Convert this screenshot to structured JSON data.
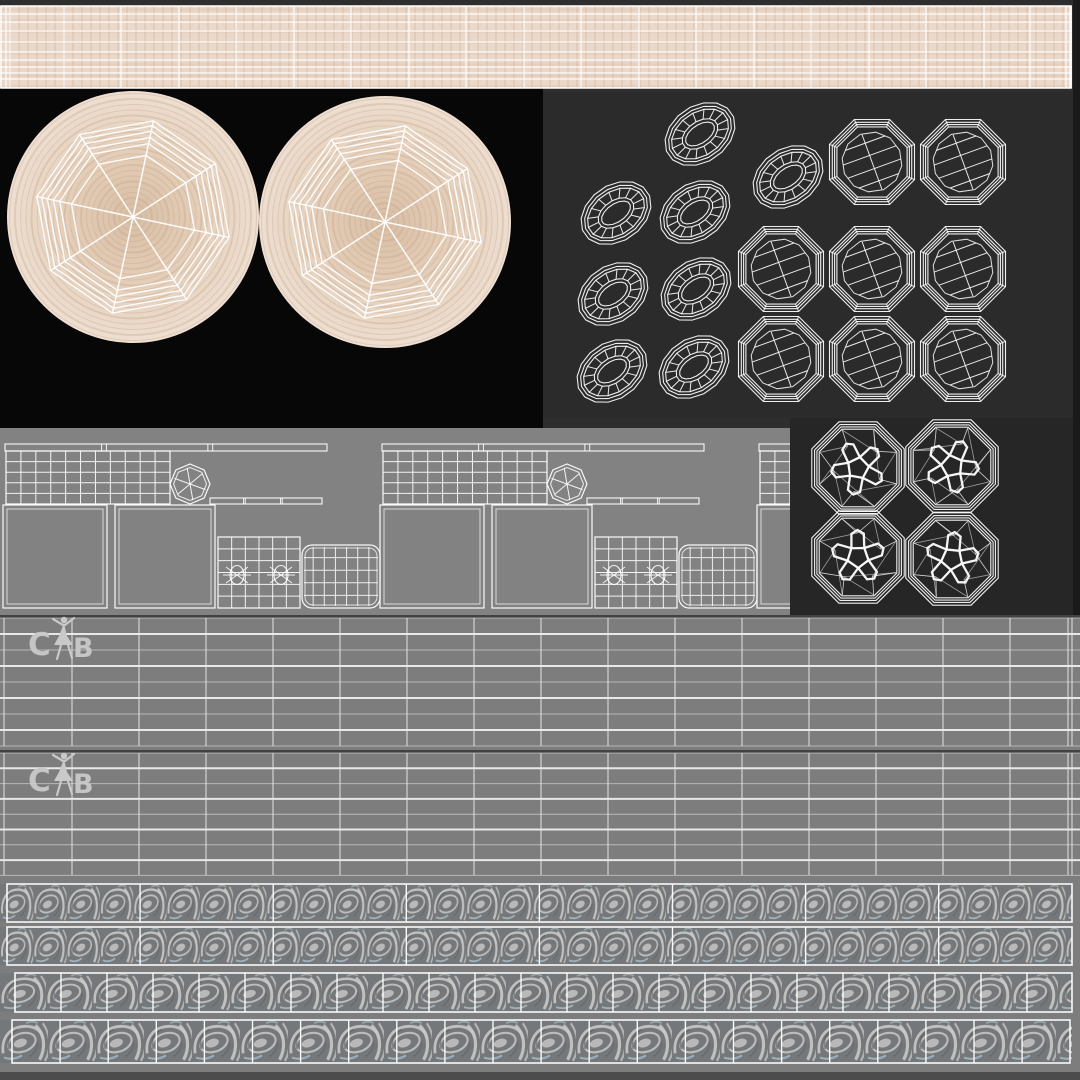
{
  "title": "3D model UV wireframe texture atlas",
  "logo": {
    "name": "CB ballet brand mark",
    "letter_left": "C",
    "letter_right": "B"
  },
  "colors": {
    "canvas_bg": "#2e2e2e",
    "wood": "#ead8ca",
    "wood_center": "#d8bda4",
    "wood_mid": "#e2cbb5",
    "wood_edge": "#eedfd2",
    "wood_grain": "#c2a184",
    "black_panel": "#070707",
    "rings_panel": "#2b2b2b",
    "gems_panel": "#262626",
    "gray_panel": "#828282",
    "band_bg": "#7d7d7d",
    "wire": "#ffffff",
    "band_line": "#e9e9e9",
    "band_line_bright": "#f4f4f4",
    "section_border": "#3c3c3c",
    "logo_color": "#c9c9c9",
    "wave_bg": "#75787b",
    "wave_light": "#c9c9c7",
    "wave_blue": "#b3c8d4",
    "wave_dark": "#5a5e62",
    "right_band": "#1a1a1a",
    "bottom_strip": "#4c4c4c",
    "lower_bg": "#7d7d7d"
  },
  "wood_strip": {
    "x": 0,
    "y": 6,
    "w": 1072,
    "h": 82,
    "verticals": [
      6,
      10,
      64,
      121,
      179,
      236,
      294,
      351,
      409,
      466,
      524,
      581,
      639,
      696,
      754,
      811,
      869,
      926,
      984,
      1030,
      1066,
      1070
    ],
    "horizontals": [
      8,
      16,
      25,
      36,
      46,
      54,
      61,
      67,
      73
    ]
  },
  "disc_panel": {
    "x": 0,
    "y": 88,
    "w": 543,
    "h": 340,
    "discs": [
      {
        "cx": 133,
        "cy": 217,
        "r": 126
      },
      {
        "cx": 385,
        "cy": 222,
        "r": 126
      }
    ],
    "ring_fracs": [
      0.5,
      0.595,
      0.645,
      0.695,
      0.74,
      0.78
    ],
    "spoke_angle_offset": 12
  },
  "rings_panel": {
    "x": 543,
    "y": 92,
    "w": 530,
    "h": 326,
    "oval_rot": -35,
    "oval_rx": 38,
    "oval_ry": 28,
    "ovals": [
      {
        "cx": 700,
        "cy": 134
      },
      {
        "cx": 788,
        "cy": 177
      },
      {
        "cx": 616,
        "cy": 213
      },
      {
        "cx": 695,
        "cy": 212
      },
      {
        "cx": 613,
        "cy": 294
      },
      {
        "cx": 696,
        "cy": 289
      },
      {
        "cx": 612,
        "cy": 371
      },
      {
        "cx": 694,
        "cy": 367
      }
    ],
    "disc_r": 46,
    "discs": [
      {
        "cx": 872,
        "cy": 162
      },
      {
        "cx": 963,
        "cy": 162
      },
      {
        "cx": 781,
        "cy": 269
      },
      {
        "cx": 872,
        "cy": 269
      },
      {
        "cx": 963,
        "cy": 269
      },
      {
        "cx": 781,
        "cy": 359
      },
      {
        "cx": 872,
        "cy": 359
      },
      {
        "cx": 963,
        "cy": 359
      }
    ]
  },
  "gray_panel": {
    "x": 0,
    "y": 428,
    "w": 790,
    "h": 187,
    "copy_offsets": [
      0,
      377,
      754
    ]
  },
  "gems_panel": {
    "x": 790,
    "y": 418,
    "w": 283,
    "h": 197,
    "r": 50,
    "gems": [
      {
        "cx": 858,
        "cy": 468,
        "rot": 10
      },
      {
        "cx": 952,
        "cy": 466,
        "rot": -12
      },
      {
        "cx": 858,
        "cy": 557,
        "rot": 35
      },
      {
        "cx": 952,
        "cy": 559,
        "rot": -30
      }
    ]
  },
  "band_sections": [
    {
      "y": 615,
      "h": 133,
      "rows": 9,
      "row_step": 16.0,
      "logo_x": 28,
      "logo_y": 616
    },
    {
      "y": 750,
      "h": 127,
      "rows": 9,
      "row_step": 15.3,
      "logo_x": 28,
      "logo_y": 752
    }
  ],
  "band_verticals": [
    4,
    72,
    139,
    206,
    273,
    340,
    407,
    474,
    541,
    608,
    675,
    742,
    809,
    876,
    943,
    1010,
    1068,
    1072
  ],
  "wave_rows": [
    {
      "y": 884,
      "h": 38,
      "x0": 7,
      "x1": 1072,
      "step": 133.1,
      "motif_w": 33.3
    },
    {
      "y": 927,
      "h": 38,
      "x0": 7,
      "x1": 1072,
      "step": 133.1,
      "motif_w": 33.3
    },
    {
      "y": 973,
      "h": 39,
      "x0": 15,
      "x1": 1072,
      "step": 46.0,
      "motif_w": 46
    },
    {
      "y": 1020,
      "h": 43,
      "x0": 12,
      "x1": 1070,
      "step": 48.1,
      "motif_w": 48
    }
  ],
  "lower_bg": {
    "y": 612,
    "h": 460
  },
  "right_band": {
    "x": 1073,
    "y": 0,
    "w": 7,
    "h": 615
  },
  "bottom_strip": {
    "y": 1072,
    "h": 8
  }
}
